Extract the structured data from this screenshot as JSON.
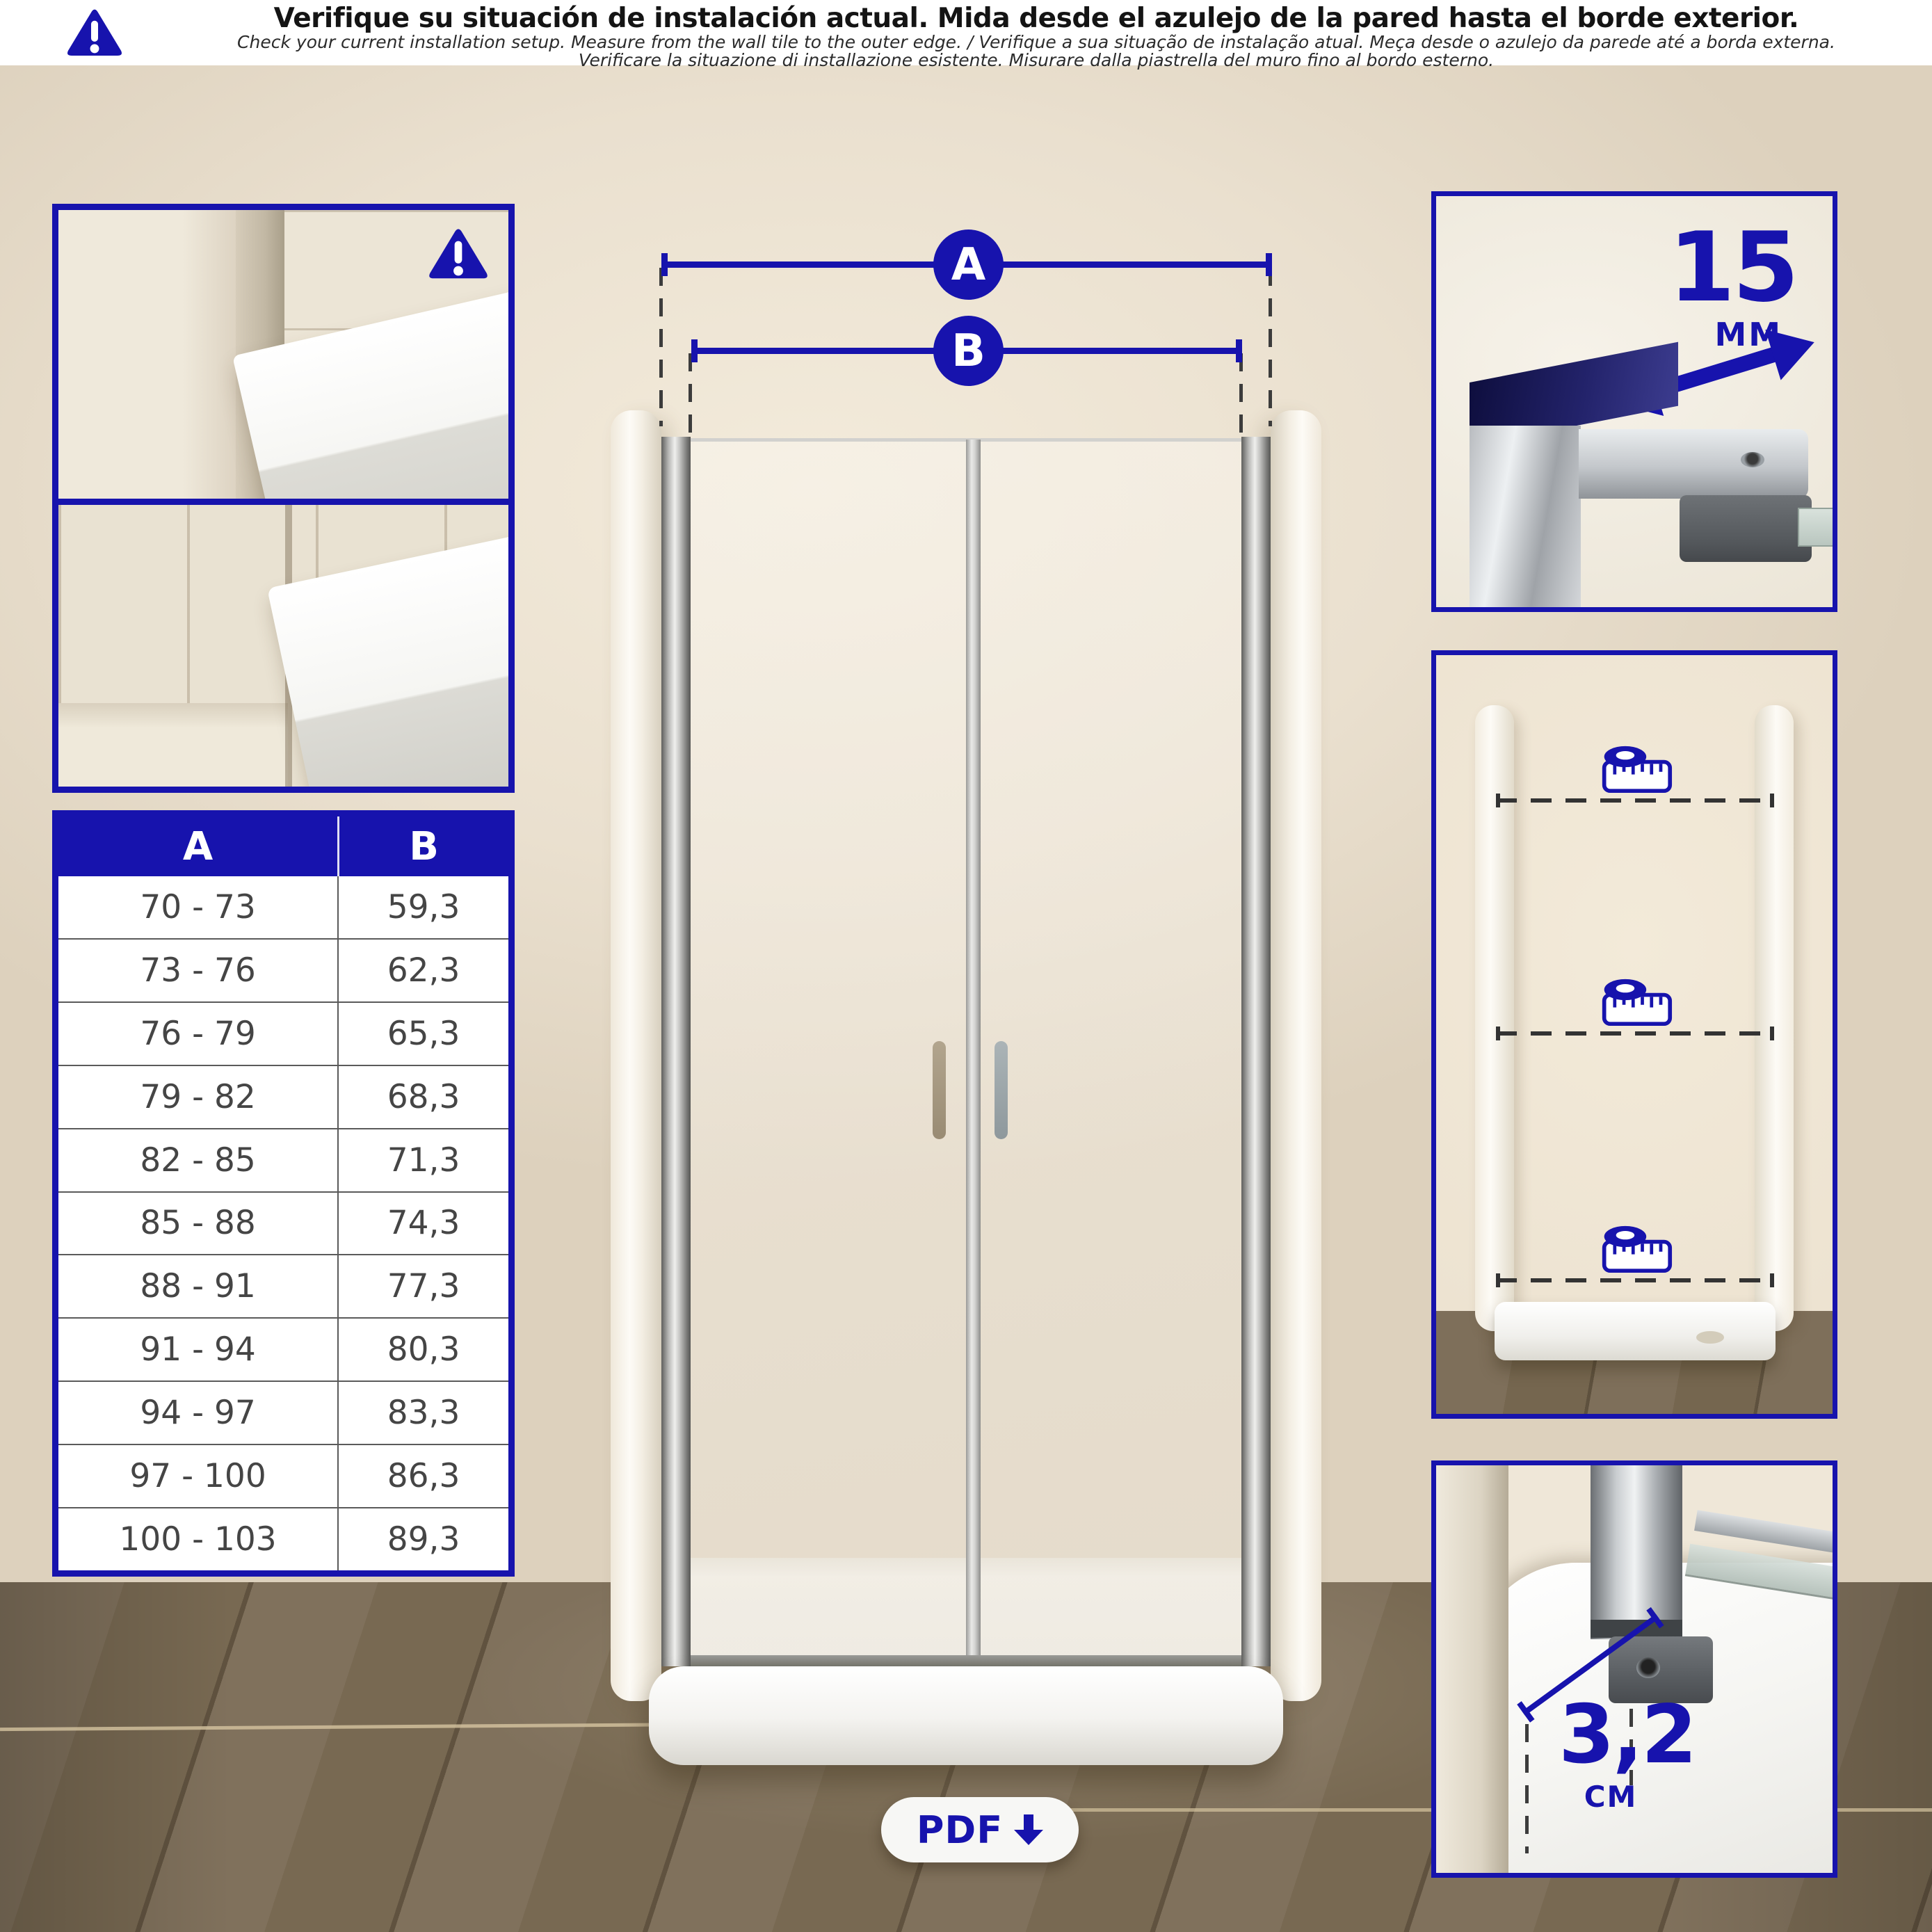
{
  "header": {
    "title": "Verifique su situación de instalación actual. Mida desde el azulejo de la pared hasta el borde exterior.",
    "subtitle_en_pt": "Check your current installation setup. Measure from the wall tile to the outer edge. / Verifique a sua situação de instalação atual. Meça desde o azulejo da parede até a borda externa.",
    "subtitle_it": "Verificare la situazione di installazione esistente. Misurare dalla piastrella del muro fino al bordo esterno.",
    "warning_symbol": "!"
  },
  "measurements": {
    "label_a": "A",
    "label_b": "B"
  },
  "size_table": {
    "col_a": "A",
    "col_b": "B",
    "rows": [
      {
        "a": "70 - 73",
        "b": "59,3"
      },
      {
        "a": "73 - 76",
        "b": "62,3"
      },
      {
        "a": "76 - 79",
        "b": "65,3"
      },
      {
        "a": "79 - 82",
        "b": "68,3"
      },
      {
        "a": "82 - 85",
        "b": "71,3"
      },
      {
        "a": "85 - 88",
        "b": "74,3"
      },
      {
        "a": "88 - 91",
        "b": "77,3"
      },
      {
        "a": "91 - 94",
        "b": "80,3"
      },
      {
        "a": "94 - 97",
        "b": "83,3"
      },
      {
        "a": "97 - 100",
        "b": "86,3"
      },
      {
        "a": "100 - 103",
        "b": "89,3"
      }
    ]
  },
  "panel_adjustment": {
    "value": "15",
    "unit": "MM"
  },
  "panel_profile": {
    "value": "3,2",
    "unit": "CM"
  },
  "pdf_button": {
    "label": "PDF"
  },
  "icons": {
    "warning-icon": "!",
    "tape-measure-icon": "📏",
    "double-arrow-icon": "↔",
    "download-icon": "↓"
  },
  "colors": {
    "primary_blue": "#1713ad",
    "wall_beige": "#ece2d2",
    "floor_brown": "#7a6b56"
  }
}
